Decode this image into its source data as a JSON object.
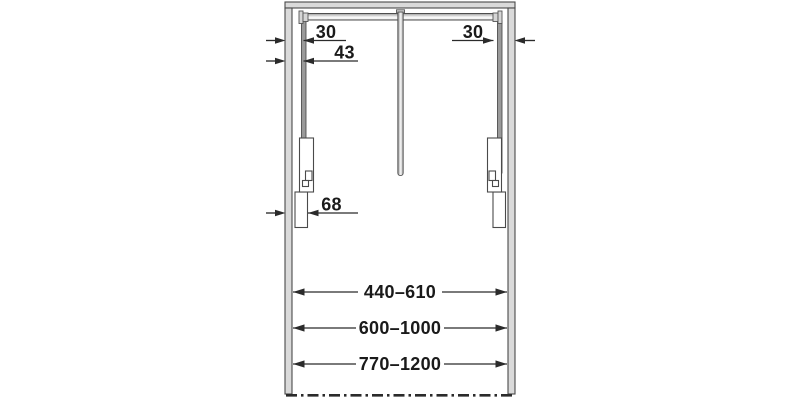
{
  "diagram": {
    "dims": {
      "offset_left_inner": "30",
      "offset_left_outer": "43",
      "offset_right": "30",
      "offset_side": "68",
      "width_range_small": "440–610",
      "width_range_medium": "600–1000",
      "width_range_large": "770–1200"
    },
    "colors": {
      "line": "#2b2b2b",
      "panel_fill": "#dadada",
      "panel_stroke": "#4a4a4a",
      "arm_fill": "#9a9a9a",
      "text": "#1a1a1a",
      "background": "#ffffff"
    }
  }
}
